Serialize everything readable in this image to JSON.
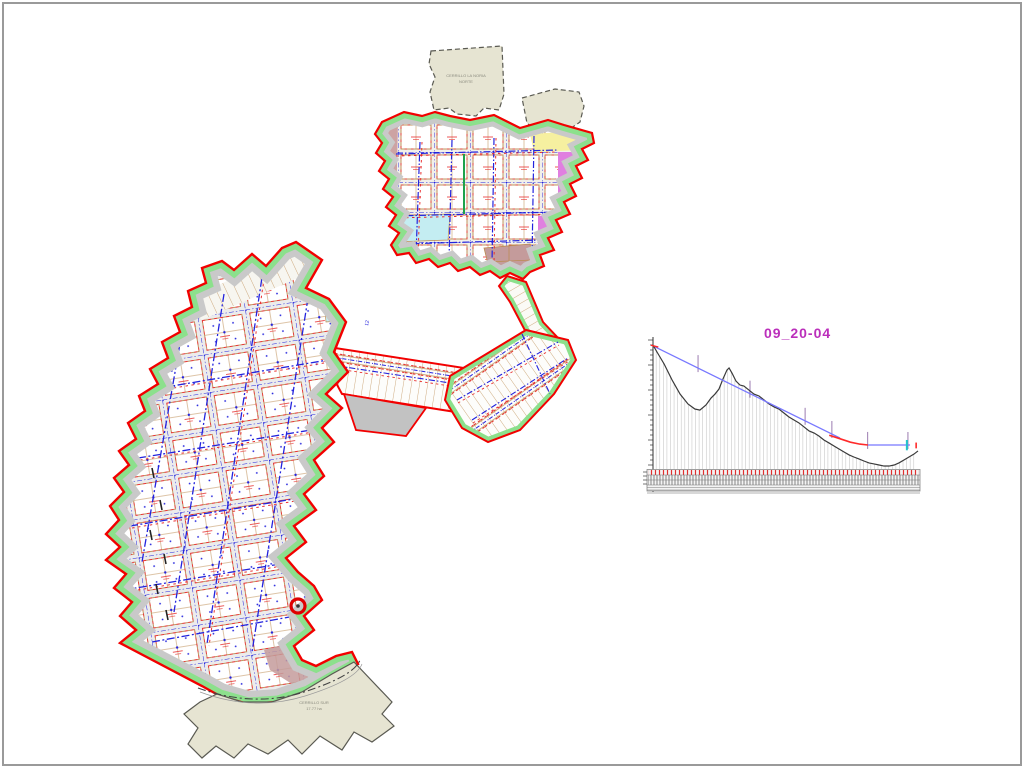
{
  "page": {
    "background": "#ffffff",
    "border_color": "#9a9a9a"
  },
  "colors": {
    "red": "#f20000",
    "redDash": "#e83030",
    "greenFill": "#8ce08c",
    "greenStroke": "#1da24c",
    "blue": "#2323dd",
    "tan": "#bc8a4e",
    "grayBase": "#c9c9c9",
    "grayWedge": "#c2c2c2",
    "beige": "#e6e4d2",
    "zoneYellow": "#f6f0a0",
    "zoneMagenta": "#e07fe0",
    "zoneCyan": "#c4edf2",
    "zoneRosy": "#cda3a3",
    "zoneLavender": "#c9c9e2",
    "zoneBrown": "#c49b9b",
    "magentaLabel": "#bb2fbb",
    "borderGray": "#9a9a9a",
    "terrain": "#3a3a3a",
    "grade": "#7878ff",
    "curve": "#ff2a2a",
    "ordinate": "#c9c9c9",
    "markerPurple": "#9b7bb0",
    "cyanMark": "#22c4cc",
    "bandTick": "#e03030",
    "bandDense": "#555555"
  },
  "map": {
    "top_area_label": {
      "line1": "CERRILLO LA NORIA",
      "line2": "NORTE"
    },
    "bottom_area_label": {
      "line1": "CERRILLO SUR",
      "line2": "17.77 ha"
    },
    "tiny_blue_label": "12",
    "marker": {
      "shape": "red-circle",
      "x": 296,
      "y": 604
    }
  },
  "chart_data": {
    "type": "line",
    "title": "09_20-04",
    "x_unit": "percent_of_alignment_length",
    "y_unit": "percent_of_plot_height_from_top",
    "axis": {
      "y_ticks": "unlabeled elevation ticks",
      "grid": "vertical station ordinates"
    },
    "legend_position": "none",
    "series": [
      {
        "name": "existing-terrain",
        "color_key": "terrain",
        "points": [
          [
            0,
            3.9
          ],
          [
            1.5,
            9.3
          ],
          [
            4.2,
            18.6
          ],
          [
            7.2,
            31
          ],
          [
            10.2,
            41.9
          ],
          [
            13.2,
            49.6
          ],
          [
            15.8,
            53.5
          ],
          [
            17.7,
            54.3
          ],
          [
            20,
            50.4
          ],
          [
            21.9,
            45
          ],
          [
            23.4,
            41.9
          ],
          [
            24.9,
            38
          ],
          [
            26.4,
            30.2
          ],
          [
            27.9,
            23.3
          ],
          [
            28.7,
            21.7
          ],
          [
            29.8,
            25.6
          ],
          [
            31.3,
            31.8
          ],
          [
            32.8,
            34.9
          ],
          [
            34.3,
            35.7
          ],
          [
            36.2,
            38.8
          ],
          [
            38.1,
            41.9
          ],
          [
            40,
            43.4
          ],
          [
            41.9,
            46.5
          ],
          [
            43.8,
            49.6
          ],
          [
            45.7,
            51.9
          ],
          [
            47.5,
            53.5
          ],
          [
            49.4,
            56.6
          ],
          [
            51.3,
            59.7
          ],
          [
            53.2,
            62
          ],
          [
            55.1,
            64.3
          ],
          [
            57,
            67.4
          ],
          [
            58.9,
            70.5
          ],
          [
            60.8,
            72.1
          ],
          [
            62.6,
            74.4
          ],
          [
            64.5,
            77.5
          ],
          [
            66.4,
            79.8
          ],
          [
            68.3,
            82.2
          ],
          [
            70.2,
            84.5
          ],
          [
            72.1,
            86.8
          ],
          [
            74,
            89.1
          ],
          [
            75.8,
            90.7
          ],
          [
            77.7,
            92.2
          ],
          [
            79.6,
            93.8
          ],
          [
            81.5,
            95.3
          ],
          [
            83.4,
            96.1
          ],
          [
            85.3,
            96.9
          ],
          [
            87.2,
            97.7
          ],
          [
            89.1,
            97.7
          ],
          [
            91,
            96.9
          ],
          [
            92.8,
            95.3
          ],
          [
            94.7,
            93
          ],
          [
            96.6,
            90.7
          ],
          [
            98.5,
            88.4
          ],
          [
            100,
            86
          ]
        ]
      },
      {
        "name": "design-grade",
        "color_key": "grade",
        "points": [
          [
            0.8,
            5.4
          ],
          [
            70.6,
            76
          ],
          [
            81.1,
            81.4
          ],
          [
            97,
            81.4
          ]
        ]
      },
      {
        "name": "vertical-curve",
        "color_key": "curve",
        "points": [
          [
            66.5,
            73.8
          ],
          [
            70.5,
            76.5
          ],
          [
            74.5,
            79.2
          ],
          [
            78,
            80.7
          ],
          [
            81.1,
            81.4
          ]
        ]
      }
    ],
    "ordinates": {
      "spacing_percent": 1.35,
      "color_key": "ordinate"
    },
    "event_markers_x_percent": [
      17,
      36.6,
      57.4,
      67.5,
      81,
      96.2
    ],
    "end_markers": {
      "cyan_x_percent": 95.8,
      "red_x_percent": 99.3
    },
    "band_blobs_x_percent": [
      1,
      20,
      42,
      53,
      67,
      76,
      85,
      95
    ]
  }
}
